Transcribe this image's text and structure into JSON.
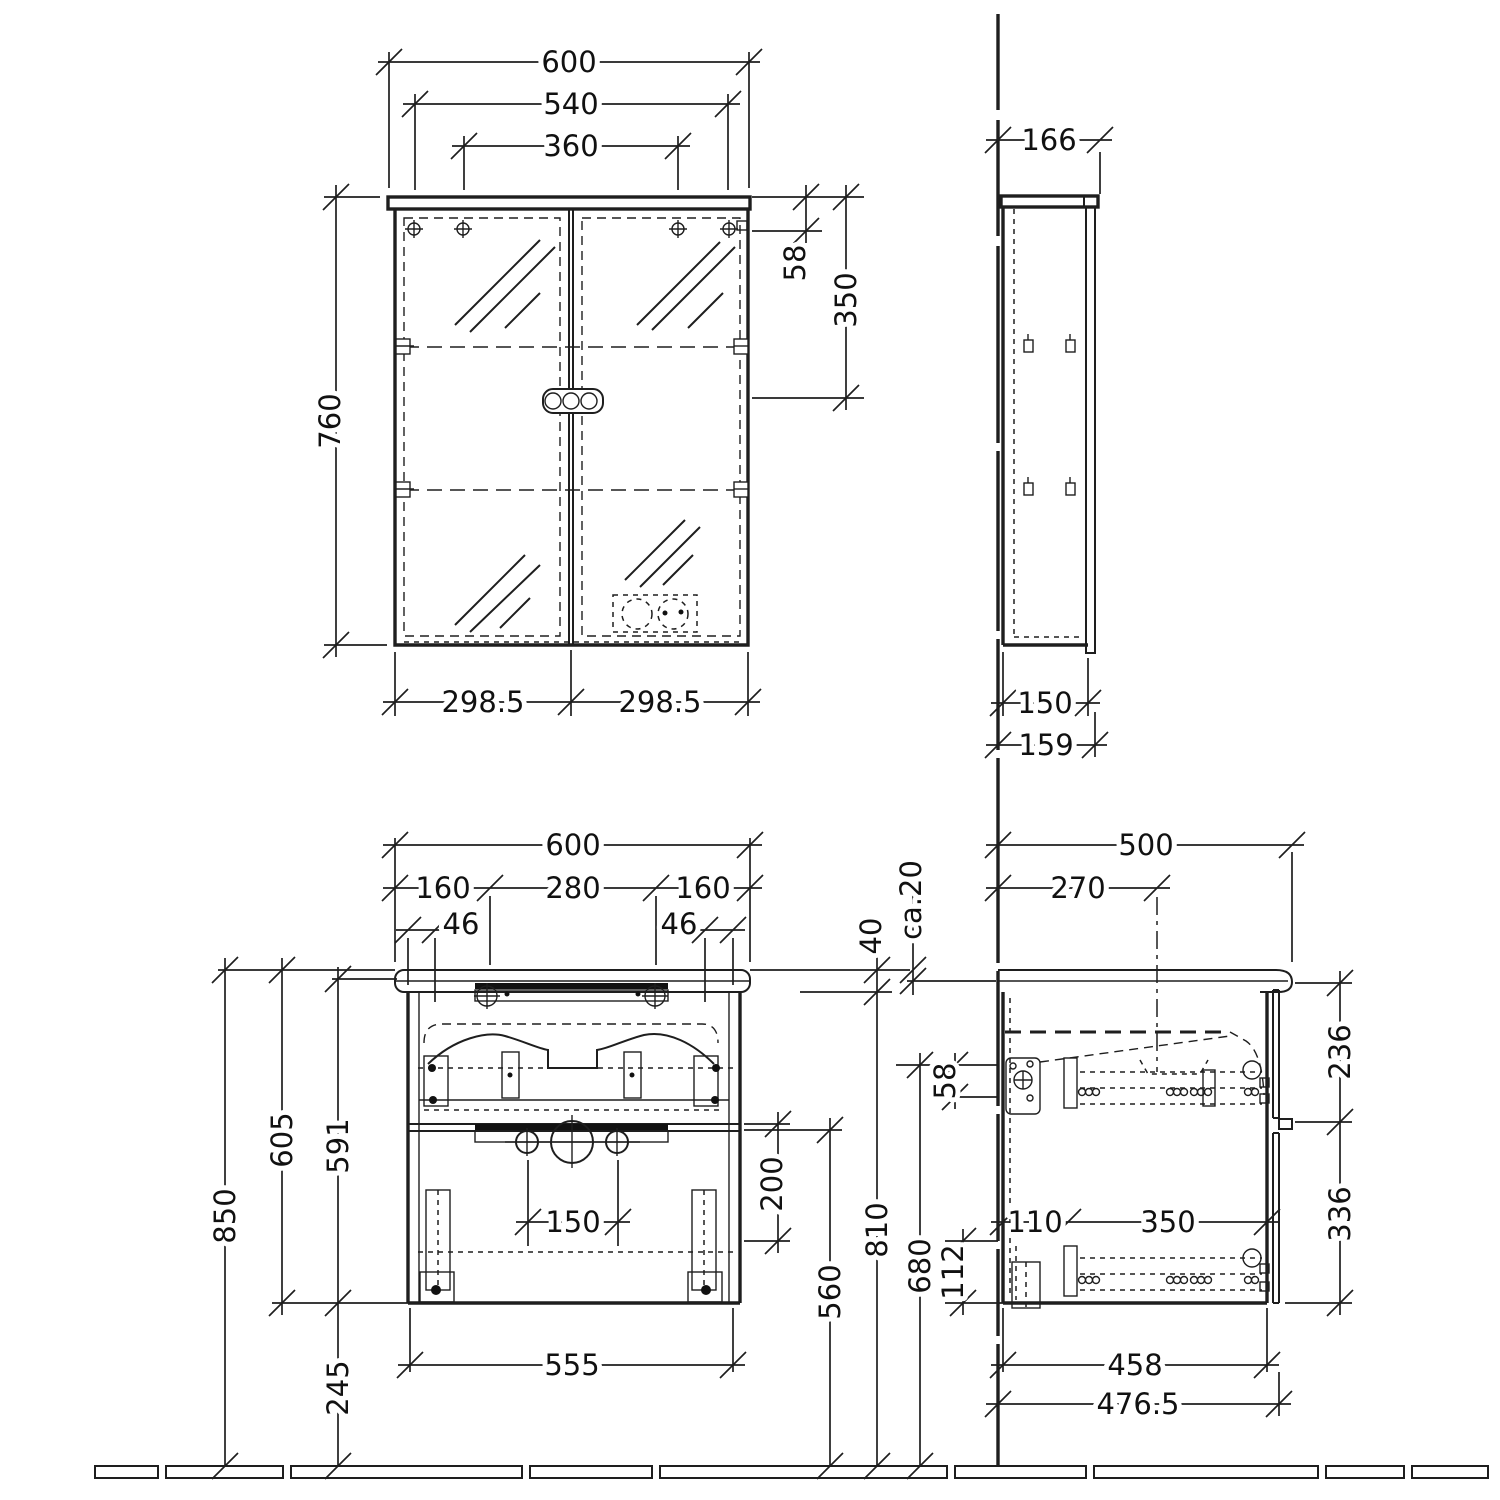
{
  "title": "Bathroom vanity and mirror cabinet technical drawing",
  "units": "mm",
  "colors": {
    "line": "#1e1e1e",
    "background": "#ffffff"
  },
  "views": {
    "mirror_front": {
      "name": "mirror cabinet front view",
      "dims": {
        "total_width": "600",
        "hanger_width": "540",
        "inner_hole_width": "360",
        "height": "760",
        "top_offset": "58",
        "mount_spacing": "350",
        "door_left": "298.5",
        "door_right": "298.5"
      }
    },
    "mirror_side": {
      "name": "mirror cabinet side view",
      "dims": {
        "total_depth": "166",
        "body_depth": "150",
        "front_depth": "159"
      }
    },
    "vanity_front": {
      "name": "vanity unit front view",
      "dims": {
        "total_width": "600",
        "hole_left": "160",
        "hole_center": "280",
        "hole_right": "160",
        "edge_left": "46",
        "edge_right": "46",
        "total_height": "850",
        "basin_to_bottom": "605",
        "carcass_height": "591",
        "floor_clearance": "245",
        "drain_spacing": "150",
        "drawer_inner": "200",
        "divider_height": "560",
        "rim_height": "810",
        "drain_height": "680",
        "carcass_width": "555",
        "basin_edge": "40",
        "overhang": "ca.20"
      }
    },
    "vanity_side": {
      "name": "vanity unit side view",
      "dims": {
        "total_depth": "500",
        "faucet_axis_depth": "270",
        "rail_top_offset": "58",
        "rail_bottom_offset": "112",
        "rail_back_offset": "110",
        "rail_length": "350",
        "top_drawer_height": "236",
        "bottom_drawer_height": "336",
        "carcass_depth": "458",
        "overall_depth": "476.5"
      }
    }
  }
}
